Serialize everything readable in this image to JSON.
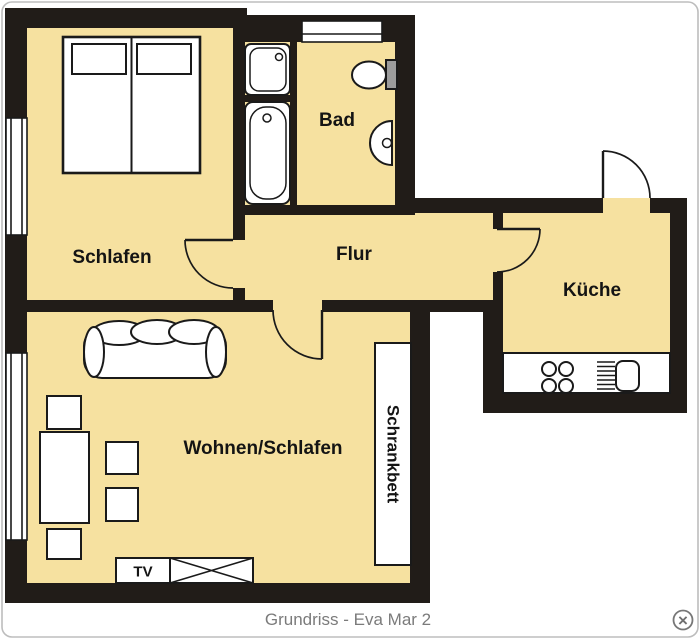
{
  "colors": {
    "floor": "#f6e1a0",
    "wall": "#211c18",
    "line": "#1a1a1a",
    "tank": "#9c9c9c",
    "caption": "#7b7b7b",
    "frame": "#bdbdbd"
  },
  "rooms": {
    "schlafen": "Schlafen",
    "bad": "Bad",
    "flur": "Flur",
    "kueche": "Küche",
    "wohnen": "Wohnen/Schlafen"
  },
  "furniture": {
    "wallbed": "Schrankbett",
    "tv": "TV"
  },
  "caption": "Grundriss - Eva Mar 2",
  "close": "×"
}
